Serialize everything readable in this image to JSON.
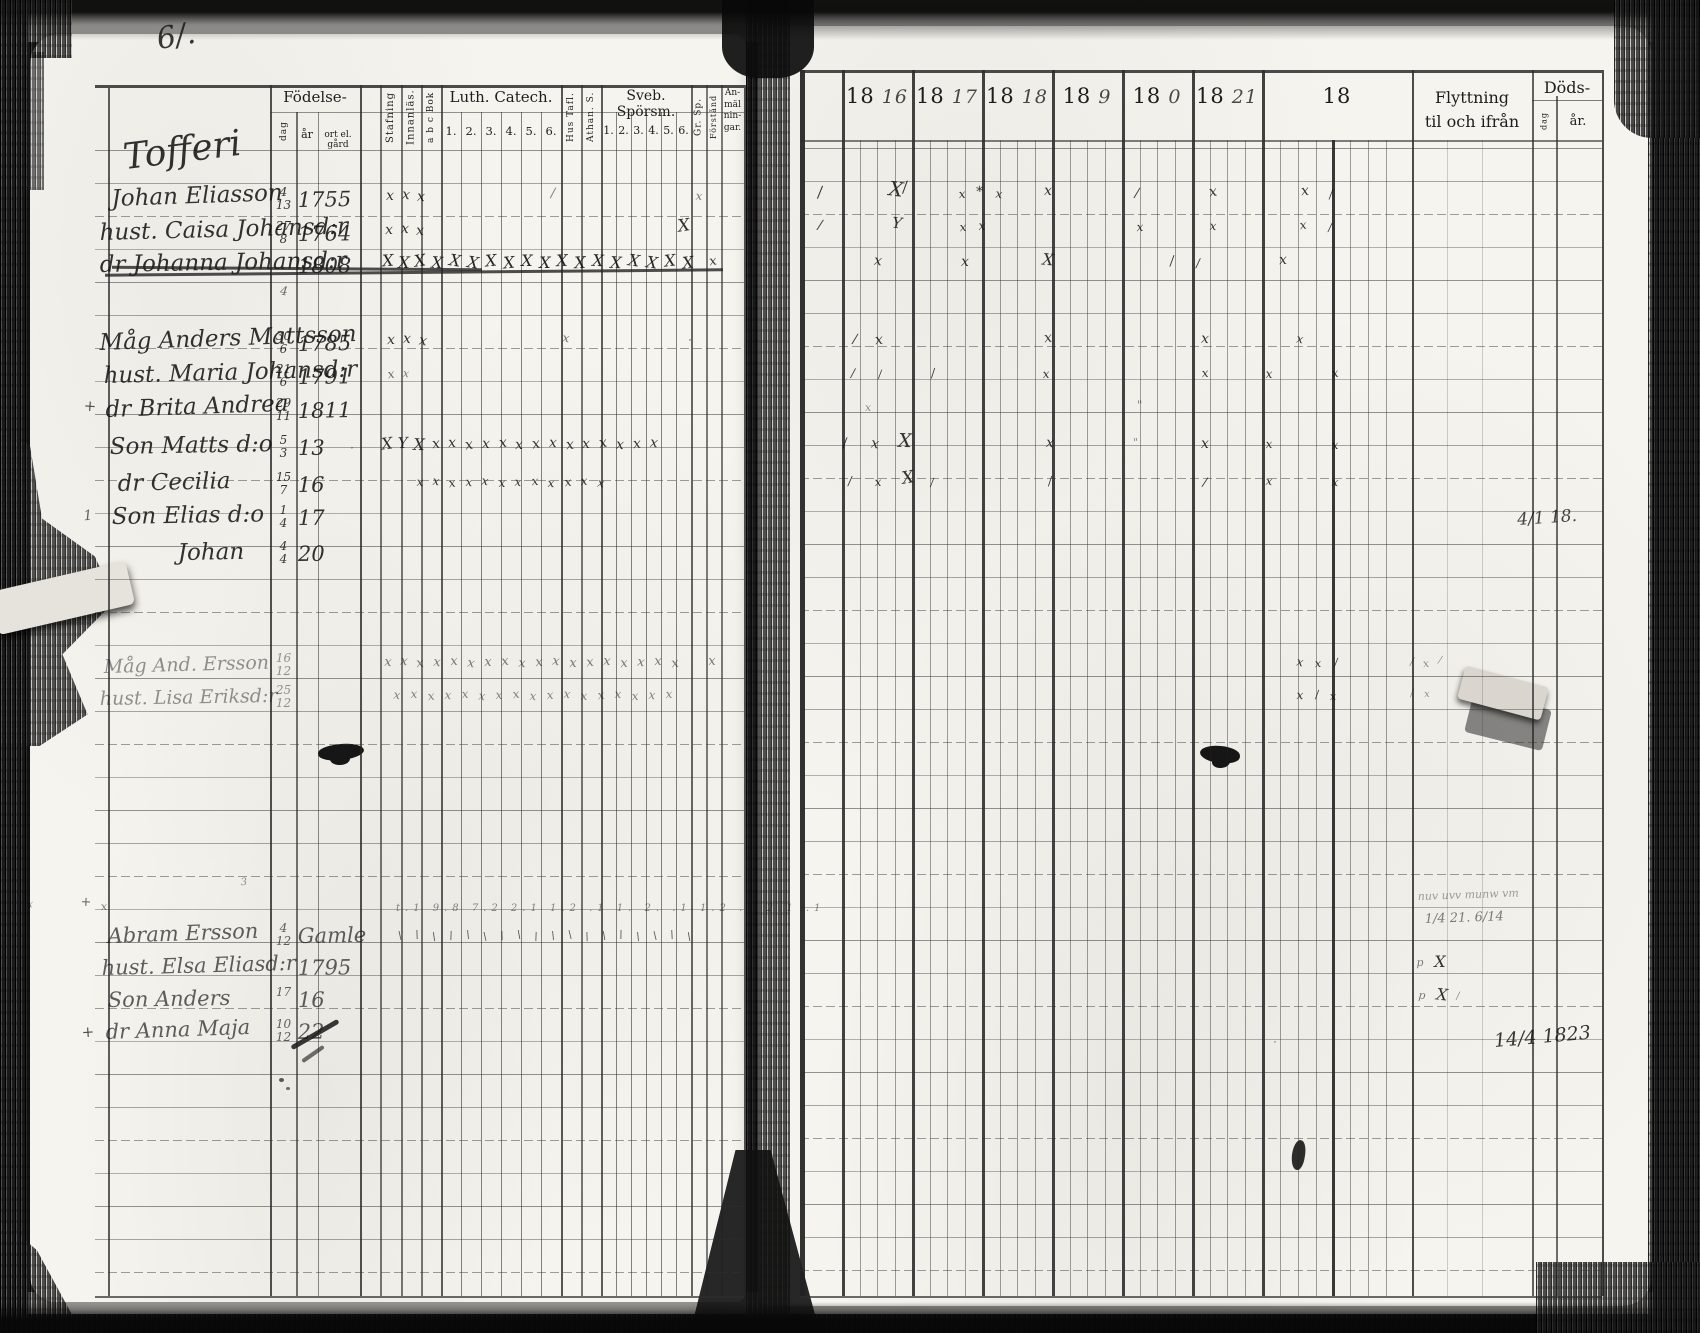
{
  "left_page": {
    "page_number": "6/.",
    "header": {
      "fodelse": {
        "label": "Födelse-",
        "dag": "dag",
        "ar": "år",
        "ort": "ort el. gård"
      },
      "stafning": "Stafning",
      "innanlas": "Innanläs.",
      "abcbok": "a b c Bok",
      "luth": {
        "label": "Luth. Catech.",
        "cols": [
          "1.",
          "2.",
          "3.",
          "4.",
          "5.",
          "6."
        ]
      },
      "hustafl": "Hus Tafl.",
      "athan": "Athan. S.",
      "sveb": {
        "label": "Sveb. Spörsm.",
        "cols": [
          "1.",
          "2.",
          "3.",
          "4.",
          "5.",
          "6."
        ]
      },
      "grsp": "Gr. Sp.",
      "forstand": "Förstånd",
      "anm": "An-\nmäl\nnin-\ngar."
    },
    "rows": [
      {
        "y": 176,
        "x": 126,
        "name": "Tofferi",
        "s": 36,
        "r": -7,
        "cls": "heading"
      },
      {
        "y": 212,
        "x": 112,
        "name": "Johan Eliasson",
        "d": "4",
        "m": "13",
        "yr": "1755",
        "r": -2
      },
      {
        "y": 246,
        "x": 100,
        "name": "hust. Caisa Johansd:r",
        "d": "27",
        "m": "8",
        "yr": "1764",
        "r": -1.5
      },
      {
        "y": 278,
        "x": 100,
        "name": "dr Johanna Johansd:r",
        "yr": "1808",
        "r": -1,
        "cls": "struck"
      },
      {
        "y": 356,
        "x": 100,
        "name": "Måg Anders Mattsson",
        "d": "30",
        "m": "6",
        "yr": "1785",
        "r": -2
      },
      {
        "y": 389,
        "x": 104,
        "name": "hust. Maria Johansd:r",
        "d": "21",
        "m": "6",
        "yr": "1791",
        "r": -1.5
      },
      {
        "y": 423,
        "x": 106,
        "name": "dr Brita Andrea",
        "d": "29",
        "m": "11",
        "yr": "1811",
        "r": -2
      },
      {
        "y": 460,
        "x": 110,
        "name": "Son Matts d:o",
        "d": "5",
        "m": "3",
        "yr": "13",
        "r": -1
      },
      {
        "y": 497,
        "x": 118,
        "name": "dr Cecilia",
        "d": "15",
        "m": "7",
        "yr": "16",
        "r": -1.5
      },
      {
        "y": 530,
        "x": 112,
        "name": "Son Elias d:o",
        "d": "1",
        "m": "4",
        "yr": "17",
        "r": -1
      },
      {
        "y": 566,
        "x": 178,
        "name": "Johan",
        "d": "4",
        "m": "4",
        "yr": "20",
        "r": -1
      },
      {
        "y": 678,
        "x": 104,
        "name": "Måg And. Ersson",
        "d": "16",
        "m": "12",
        "r": -1.5,
        "cls": "faint"
      },
      {
        "y": 710,
        "x": 100,
        "name": "hust. Lisa Eriksd:r",
        "d": "25",
        "m": "12",
        "r": -1,
        "cls": "faint"
      },
      {
        "y": 948,
        "x": 108,
        "name": "Abram Ersson",
        "d": "4",
        "m": "12",
        "yr": "Gamle",
        "r": -2,
        "cls": "light"
      },
      {
        "y": 980,
        "x": 102,
        "name": "hust. Elsa Eliasd:r",
        "yr": "1795",
        "r": -1.5,
        "cls": "light"
      },
      {
        "y": 1012,
        "x": 108,
        "name": "Son Anders",
        "d": "17",
        "yr": "16",
        "r": -1,
        "cls": "light"
      },
      {
        "y": 1044,
        "x": 106,
        "name": "dr Anna Maja",
        "d": "10",
        "m": "12",
        "yr": "22",
        "r": -2,
        "cls": "light"
      }
    ]
  },
  "right_page": {
    "header": {
      "years": [
        {
          "p": "18",
          "w": "16"
        },
        {
          "p": "18",
          "w": "17"
        },
        {
          "p": "18",
          "w": "18"
        },
        {
          "p": "18",
          "w": "9"
        },
        {
          "p": "18",
          "w": "0"
        },
        {
          "p": "18",
          "w": "21"
        },
        {
          "p": "18",
          "w": ""
        }
      ],
      "flyttning": "Flyttning\ntil och ifrån",
      "dods": "Döds-",
      "dods_dag": "dag",
      "dods_ar": "år."
    }
  },
  "strike_lines": [
    {
      "x": 105,
      "w": 618,
      "y": 271,
      "r": -0.5
    },
    {
      "x": 112,
      "w": 370,
      "y": 267,
      "r": 0.4
    }
  ],
  "annotations": [
    {
      "t": "6/.",
      "x": 160,
      "y": 22,
      "s": 30,
      "o": 0.85,
      "r": -10
    },
    {
      "t": "4/1 18.",
      "x": 1518,
      "y": 510,
      "s": 17,
      "o": 0.8,
      "r": -4
    },
    {
      "t": "14/4 1823",
      "x": 1495,
      "y": 1030,
      "s": 19,
      "o": 0.85,
      "r": -5
    },
    {
      "t": "nuv uvv munw vm",
      "x": 1418,
      "y": 890,
      "s": 11,
      "o": 0.4,
      "r": -2
    },
    {
      "t": "1/4 21. 6/14",
      "x": 1425,
      "y": 912,
      "s": 13,
      "o": 0.55,
      "r": -2
    },
    {
      "t": "t.1 9.8 7.2 2.1 1.2 .1 1. 2. .1 1.2 .1 2.1 .1",
      "x": 396,
      "y": 903,
      "s": 10,
      "o": 0.5,
      "ls": 5
    },
    {
      "t": "– ·– — · · –– –· · — — – ·",
      "x": 64,
      "y": 0,
      "s": 11,
      "o": 0.3,
      "ls": 5
    }
  ],
  "marks": [
    [
      390,
      200
    ],
    [
      406,
      199
    ],
    [
      421,
      201
    ],
    [
      553,
      197,
      "/",
      13,
      0.55
    ],
    [
      699,
      199,
      "x",
      12,
      0.55
    ],
    [
      389,
      234
    ],
    [
      405,
      233
    ],
    [
      420,
      235
    ],
    [
      684,
      231,
      "X",
      17
    ],
    [
      388,
      265,
      "X",
      16,
      0.9
    ],
    [
      404,
      267,
      "X",
      16,
      0.9
    ],
    [
      420,
      265,
      "X",
      16,
      0.9
    ],
    [
      437,
      267,
      "X",
      16,
      0.9
    ],
    [
      455,
      265,
      "X",
      16,
      0.9
    ],
    [
      473,
      267,
      "X",
      16,
      0.9
    ],
    [
      491,
      265,
      "X",
      16,
      0.9
    ],
    [
      509,
      267,
      "X",
      16,
      0.9
    ],
    [
      527,
      265,
      "X",
      16,
      0.9
    ],
    [
      545,
      267,
      "X",
      16,
      0.9
    ],
    [
      562,
      265,
      "X",
      16,
      0.9
    ],
    [
      580,
      267,
      "X",
      16,
      0.9
    ],
    [
      598,
      265,
      "X",
      16,
      0.9
    ],
    [
      616,
      267,
      "X",
      16,
      0.9
    ],
    [
      634,
      265,
      "X",
      16,
      0.9
    ],
    [
      652,
      267,
      "X",
      16,
      0.9
    ],
    [
      670,
      265,
      "X",
      16,
      0.9
    ],
    [
      688,
      267,
      "X",
      16,
      0.9
    ],
    [
      713,
      265,
      "x",
      13
    ],
    [
      284,
      294,
      "4",
      12,
      0.6
    ],
    [
      391,
      344
    ],
    [
      407,
      343
    ],
    [
      423,
      345
    ],
    [
      566,
      341,
      "x",
      12,
      0.6
    ],
    [
      690,
      343,
      "·",
      12,
      0.6
    ],
    [
      391,
      377,
      "x",
      12,
      0.6
    ],
    [
      406,
      376,
      "x",
      11,
      0.55
    ],
    [
      352,
      451,
      "·",
      12,
      0.5
    ],
    [
      387,
      448,
      "X",
      16
    ],
    [
      403,
      447,
      "Y",
      15
    ],
    [
      419,
      449,
      "X",
      16
    ],
    [
      436,
      448
    ],
    [
      452,
      447
    ],
    [
      469,
      449
    ],
    [
      486,
      448
    ],
    [
      503,
      447
    ],
    [
      519,
      449
    ],
    [
      536,
      448
    ],
    [
      553,
      447
    ],
    [
      570,
      449
    ],
    [
      586,
      448
    ],
    [
      603,
      447
    ],
    [
      620,
      449
    ],
    [
      637,
      448
    ],
    [
      654,
      447
    ],
    [
      420,
      485,
      "x",
      12
    ],
    [
      436,
      484,
      "x",
      12
    ],
    [
      452,
      486,
      "x",
      12
    ],
    [
      469,
      485,
      "x",
      12
    ],
    [
      485,
      484,
      "x",
      12
    ],
    [
      502,
      486,
      "x",
      12
    ],
    [
      518,
      485,
      "x",
      12
    ],
    [
      535,
      484,
      "x",
      12
    ],
    [
      551,
      486,
      "x",
      12
    ],
    [
      568,
      485,
      "x",
      12
    ],
    [
      584,
      484,
      "x",
      12
    ],
    [
      601,
      486,
      "x",
      12
    ],
    [
      388,
      666,
      "x",
      13,
      0.55
    ],
    [
      404,
      665,
      "x",
      13,
      0.55
    ],
    [
      420,
      667,
      "x",
      13,
      0.55
    ],
    [
      437,
      666,
      "x",
      13,
      0.55
    ],
    [
      454,
      665,
      "x",
      13,
      0.55
    ],
    [
      471,
      667,
      "x",
      13,
      0.55
    ],
    [
      488,
      666,
      "x",
      13,
      0.55
    ],
    [
      505,
      665,
      "x",
      13,
      0.55
    ],
    [
      522,
      667,
      "x",
      13,
      0.55
    ],
    [
      539,
      666,
      "x",
      13,
      0.55
    ],
    [
      556,
      665,
      "x",
      13,
      0.55
    ],
    [
      573,
      667,
      "x",
      13,
      0.55
    ],
    [
      590,
      666,
      "x",
      13,
      0.55
    ],
    [
      607,
      665,
      "x",
      13,
      0.55
    ],
    [
      624,
      667,
      "x",
      13,
      0.55
    ],
    [
      641,
      666,
      "x",
      13,
      0.55
    ],
    [
      658,
      665,
      "x",
      13,
      0.55
    ],
    [
      675,
      667,
      "x",
      13,
      0.55
    ],
    [
      712,
      665,
      "x",
      13,
      0.55
    ],
    [
      397,
      698,
      "x",
      12,
      0.5
    ],
    [
      414,
      697,
      "x",
      12,
      0.5
    ],
    [
      431,
      699,
      "x",
      12,
      0.5
    ],
    [
      448,
      698,
      "x",
      12,
      0.5
    ],
    [
      465,
      697,
      "x",
      12,
      0.5
    ],
    [
      482,
      699,
      "x",
      12,
      0.5
    ],
    [
      499,
      698,
      "x",
      12,
      0.5
    ],
    [
      516,
      697,
      "x",
      12,
      0.5
    ],
    [
      533,
      699,
      "x",
      12,
      0.5
    ],
    [
      550,
      698,
      "x",
      12,
      0.5
    ],
    [
      567,
      697,
      "x",
      12,
      0.5
    ],
    [
      584,
      699,
      "x",
      12,
      0.5
    ],
    [
      601,
      698,
      "x",
      12,
      0.5
    ],
    [
      618,
      697,
      "x",
      12,
      0.5
    ],
    [
      635,
      699,
      "x",
      12,
      0.5
    ],
    [
      652,
      698,
      "x",
      12,
      0.5
    ],
    [
      669,
      697,
      "x",
      12,
      0.5
    ],
    [
      400,
      938,
      "\\",
      11,
      0.7
    ],
    [
      417,
      937,
      "\\",
      11,
      0.7
    ],
    [
      434,
      939,
      "\\",
      11,
      0.7
    ],
    [
      451,
      938,
      "\\",
      11,
      0.7
    ],
    [
      468,
      937,
      "\\",
      11,
      0.7
    ],
    [
      485,
      939,
      "\\",
      11,
      0.7
    ],
    [
      502,
      938,
      "\\",
      11,
      0.7
    ],
    [
      519,
      937,
      "\\",
      11,
      0.7
    ],
    [
      536,
      939,
      "\\",
      11,
      0.7
    ],
    [
      553,
      938,
      "\\",
      11,
      0.7
    ],
    [
      570,
      937,
      "\\",
      11,
      0.7
    ],
    [
      587,
      939,
      "\\",
      11,
      0.7
    ],
    [
      604,
      938,
      "\\",
      11,
      0.7
    ],
    [
      621,
      937,
      "\\",
      11,
      0.7
    ],
    [
      638,
      939,
      "\\",
      11,
      0.7
    ],
    [
      655,
      938,
      "\\",
      11,
      0.7
    ],
    [
      672,
      937,
      "\\",
      11,
      0.7
    ],
    [
      689,
      939,
      "\\",
      11,
      0.7
    ],
    [
      820,
      196,
      "/",
      15
    ],
    [
      896,
      194,
      "X",
      20
    ],
    [
      905,
      191,
      "/",
      15
    ],
    [
      962,
      197,
      "x",
      12
    ],
    [
      980,
      196,
      "*",
      14
    ],
    [
      999,
      197,
      "x",
      12
    ],
    [
      1048,
      195
    ],
    [
      1137,
      197,
      "/",
      13
    ],
    [
      1213,
      196
    ],
    [
      1305,
      195
    ],
    [
      1331,
      197,
      "/",
      12
    ],
    [
      820,
      229,
      "/",
      13
    ],
    [
      897,
      227,
      "Y",
      15
    ],
    [
      963,
      230,
      "x",
      12
    ],
    [
      982,
      229,
      "x",
      12
    ],
    [
      1140,
      230,
      "x",
      12
    ],
    [
      1213,
      229,
      "x",
      12
    ],
    [
      1303,
      228,
      "x",
      12
    ],
    [
      1330,
      230,
      "/",
      11
    ],
    [
      878,
      265
    ],
    [
      965,
      266
    ],
    [
      1048,
      264,
      "X",
      16
    ],
    [
      1172,
      265,
      "/",
      13
    ],
    [
      1198,
      266,
      "/",
      12
    ],
    [
      1283,
      264
    ],
    [
      855,
      343,
      "/",
      13
    ],
    [
      879,
      344
    ],
    [
      1048,
      342
    ],
    [
      1205,
      343
    ],
    [
      1300,
      342,
      "x",
      12
    ],
    [
      853,
      376,
      "/",
      12
    ],
    [
      880,
      377,
      "/",
      11
    ],
    [
      933,
      376,
      "/",
      12
    ],
    [
      1046,
      377,
      "x",
      12
    ],
    [
      1205,
      376,
      "x",
      12
    ],
    [
      1269,
      377,
      "x",
      12
    ],
    [
      1335,
      376,
      "x",
      12
    ],
    [
      868,
      410,
      "x",
      11,
      0.45
    ],
    [
      1140,
      408,
      "\"",
      12,
      0.5
    ],
    [
      845,
      447,
      "/",
      13
    ],
    [
      875,
      448
    ],
    [
      905,
      446,
      "X",
      19
    ],
    [
      1050,
      447
    ],
    [
      1136,
      445,
      "\"",
      11,
      0.5
    ],
    [
      1205,
      448
    ],
    [
      1269,
      447,
      "x",
      12
    ],
    [
      1335,
      448,
      "x",
      12
    ],
    [
      850,
      484,
      "/",
      12
    ],
    [
      878,
      485,
      "x",
      12
    ],
    [
      908,
      483,
      "X",
      17
    ],
    [
      932,
      485,
      "/",
      11
    ],
    [
      1050,
      484,
      "/",
      12
    ],
    [
      1205,
      485,
      "/",
      12
    ],
    [
      1269,
      484,
      "x",
      12
    ],
    [
      1335,
      485,
      "x",
      12
    ],
    [
      1300,
      665,
      "x",
      12
    ],
    [
      1318,
      666,
      "x",
      11
    ],
    [
      1336,
      665,
      "/",
      11
    ],
    [
      1412,
      664,
      "/",
      11,
      0.45
    ],
    [
      1426,
      666,
      "x",
      11,
      0.45
    ],
    [
      1440,
      664,
      "/",
      10,
      0.45
    ],
    [
      1300,
      698,
      "x",
      12
    ],
    [
      1317,
      697,
      "/",
      11
    ],
    [
      1333,
      699,
      "x",
      11
    ],
    [
      1412,
      697,
      "/",
      10,
      0.45
    ],
    [
      1427,
      698,
      "x",
      10,
      0.45
    ],
    [
      1420,
      965,
      "p",
      11,
      0.55
    ],
    [
      1440,
      966,
      "X",
      16
    ],
    [
      1422,
      998,
      "p",
      11,
      0.55
    ],
    [
      1442,
      999,
      "X",
      16
    ],
    [
      1458,
      1000,
      "/",
      10,
      0.5
    ],
    [
      90,
      410,
      "+",
      15,
      0.75
    ],
    [
      88,
      520,
      "1",
      14,
      0.65
    ],
    [
      86,
      906,
      "+",
      13,
      0.65
    ],
    [
      104,
      909,
      "x",
      11,
      0.55
    ],
    [
      30,
      906,
      "x",
      11,
      0.5
    ],
    [
      88,
      1036,
      "+",
      15,
      0.75
    ],
    [
      244,
      886,
      "3",
      10,
      0.45
    ],
    [
      1275,
      1045,
      "·",
      12,
      0.5
    ]
  ]
}
